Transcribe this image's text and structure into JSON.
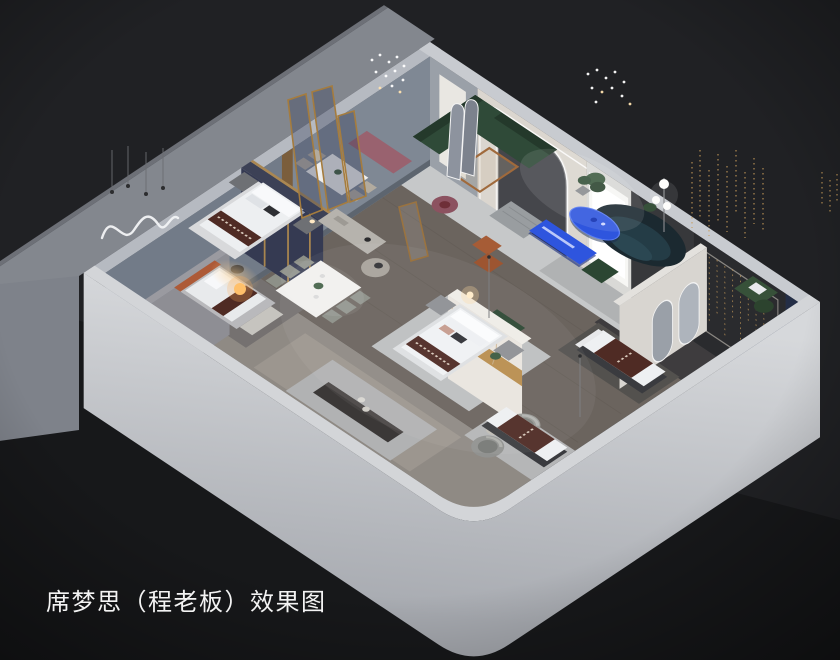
{
  "caption": {
    "text": "席梦思（程老板）效果图"
  },
  "palette": {
    "background": "#202124",
    "background_deep": "#17181a",
    "slab": "#83878e",
    "wall_outer_light": "#c9ccd1",
    "wall_top": "#d3d5d8",
    "wall_slate": "#7f8894",
    "wall_cream": "#dbd6cf",
    "wall_dark": "#2a2b2e",
    "navy_accent": "#202a44",
    "floor_wood": "#6b645e",
    "floor_dark": "#3e3c3e",
    "rug_light": "#c6c8c9",
    "accent_blue": "#2e55de",
    "sofa_green": "#2f4a38",
    "sofa_navy": "#1b2930",
    "runner_maroon": "#4f2b24",
    "gold": "#b98e4e",
    "led_white": "#ffffff",
    "lamp_warm": "#ffc06a",
    "text": "#f3f3f3"
  },
  "scene_objects": [
    "exterior-shell",
    "floor-slab",
    "showroom-floor",
    "bedroom-navy",
    "bedroom-orange",
    "bedroom-marble",
    "dining-set-4",
    "dining-set-6",
    "lounge-green-sectional",
    "navy-curved-sofa",
    "blue-coffee-table",
    "blue-tv-console",
    "arch-led-portal",
    "glow-window",
    "feature-wall-string-lights",
    "navy-accent-wall",
    "arch-mirror-wall",
    "display-mattresses",
    "wicker-swivel-chairs",
    "low-console-table",
    "pendant-crystal-lights",
    "wavy-neon-wall-art",
    "gold-framed-glass-panels"
  ]
}
